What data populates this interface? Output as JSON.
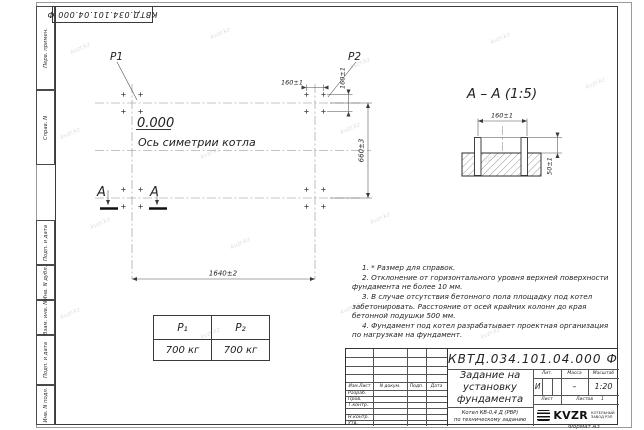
{
  "page": {
    "watermark": "kvzr.kz",
    "format_label": "Формат А3",
    "ink_color": "#333333"
  },
  "corner_stamp": {
    "doc_number": "КВТД.034.101.04.000 Ф"
  },
  "side_strip": {
    "top": [
      "Перв. примен.",
      "Справ. N"
    ],
    "bottom": [
      "Подп. и дата",
      "Инв. N дубл.",
      "Взам. инв. N",
      "Подп. и дата",
      "Инв. N подл."
    ]
  },
  "plan": {
    "p1": "P1",
    "p2": "P2",
    "elevation": "0.000",
    "axis_label": "Ось симетрии котла",
    "section_letter_left": "А",
    "section_letter_right": "А",
    "dim_length": "1640±2",
    "dim_width": "660±3",
    "dim_bolt_spacing_h": "160±1",
    "dim_bolt_spacing_v": "160±1"
  },
  "section": {
    "title": "А – А (1:5)",
    "dim_bolt_spacing": "160±1",
    "dim_bolt_height": "50±1"
  },
  "load_table": {
    "col1_header": "P₁",
    "col2_header": "P₂",
    "col1_value": "700 кг",
    "col2_value": "700 кг"
  },
  "notes": {
    "n1": "1. * Размер для справок.",
    "n2": "2. Отклонение от горизонтального уровня верхней поверхности фундамента не более 10 мм.",
    "n3": "3. В случае отсутствия бетонного пола площадку под котел забетонировать. Расстояние от осей крайних колонн до края бетонной подушки 500 мм.",
    "n4": "4. Фундамент под котел разрабатывает проектная организация по нагрузкам на фундамент."
  },
  "title_block": {
    "doc_number": "КВТД.034.101.04.000 Ф",
    "title_line1": "Задание на",
    "title_line2": "установку",
    "title_line3": "фундамента",
    "subtitle_line1": "Котел  КВ-0,4  Д  (РВР)",
    "subtitle_line2": "по техническому заданию",
    "header_col1": "Изм.Лист",
    "header_col2": "N докум.",
    "header_col3": "Подп.",
    "header_col4": "Дата",
    "role1": "Разраб.",
    "role2": "Пров.",
    "role3": "Т.контр.",
    "role4": "Н.контр.",
    "role5": "Утв.",
    "lit_label": "Лит.",
    "mass_label": "Масса",
    "scale_label": "Масштаб",
    "lit_value": "И",
    "mass_value": "–",
    "scale_value": "1:20",
    "sheet_label": "Лист",
    "sheets_label": "Листов",
    "sheets_value": "1",
    "logo_text": "KVZR",
    "logo_caption1": "КОТЕЛЬНЫЙ",
    "logo_caption2": "ЗАВОД РЭП"
  }
}
